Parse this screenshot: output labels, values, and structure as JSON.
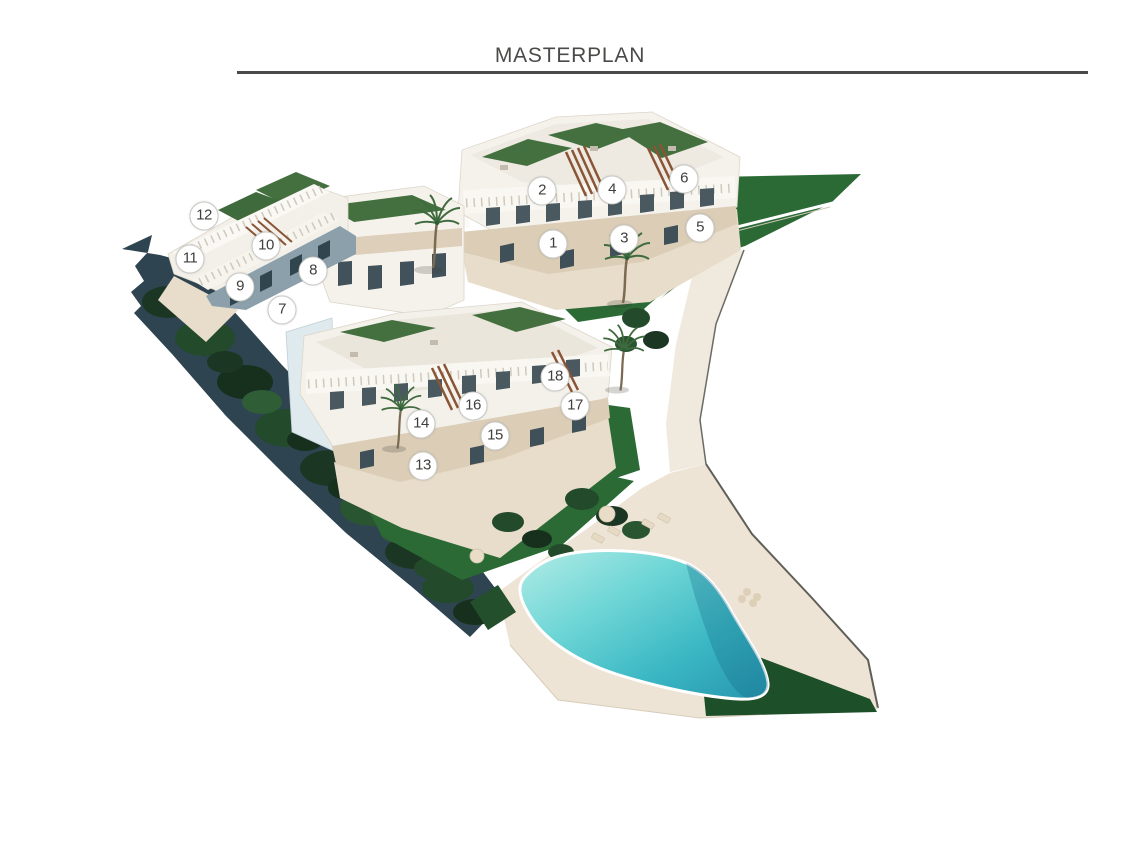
{
  "page": {
    "title": "MASTERPLAN"
  },
  "plan": {
    "marker_style": {
      "bg": "#ffffff",
      "text_color": "#3f3f3d",
      "border_color": "#c9c9c5",
      "diameter_px": 27
    },
    "markers": [
      {
        "label": "1",
        "x": 553,
        "y": 244
      },
      {
        "label": "2",
        "x": 542,
        "y": 191
      },
      {
        "label": "3",
        "x": 624,
        "y": 239
      },
      {
        "label": "4",
        "x": 612,
        "y": 190
      },
      {
        "label": "5",
        "x": 700,
        "y": 228
      },
      {
        "label": "6",
        "x": 684,
        "y": 179
      },
      {
        "label": "7",
        "x": 282,
        "y": 310
      },
      {
        "label": "8",
        "x": 313,
        "y": 271
      },
      {
        "label": "9",
        "x": 240,
        "y": 287
      },
      {
        "label": "10",
        "x": 266,
        "y": 246
      },
      {
        "label": "11",
        "x": 190,
        "y": 259
      },
      {
        "label": "12",
        "x": 204,
        "y": 216
      },
      {
        "label": "13",
        "x": 423,
        "y": 466
      },
      {
        "label": "14",
        "x": 421,
        "y": 424
      },
      {
        "label": "15",
        "x": 495,
        "y": 436
      },
      {
        "label": "16",
        "x": 473,
        "y": 406
      },
      {
        "label": "17",
        "x": 575,
        "y": 406
      },
      {
        "label": "18",
        "x": 555,
        "y": 377
      }
    ]
  },
  "palette": {
    "heading": "#4a4a48",
    "building_white": "#f5f2ec",
    "roof_garden_green": "#44703f",
    "lawn_green": "#2b6a35",
    "lawn_dark_green": "#1d4f28",
    "tree_dark_green": "#1b3622",
    "hillside_slate": "#2e4450",
    "deck_beige": "#eee4d5",
    "stone_band_beige": "#dbcdb6",
    "pergola_rust": "#8a5436",
    "pool_light": "#a8e8e2",
    "pool_deep": "#2795ae"
  }
}
